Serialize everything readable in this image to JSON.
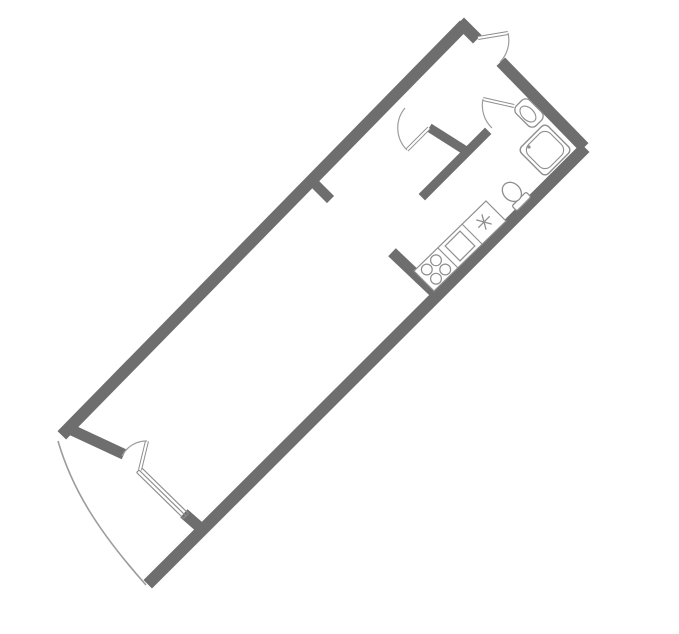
{
  "canvas": {
    "width": 679,
    "height": 634,
    "background": "#ffffff"
  },
  "palette": {
    "wall": "#6E6E6E",
    "interior_wall": "#707070",
    "fixture_line": "#8E8E8E",
    "thin_line": "#9C9C9C",
    "white": "#ffffff"
  },
  "plan": {
    "type": "studio-apartment-floor-plan",
    "rotation_note": "plan drawn rotated ~45deg, long axis from top-right to bottom-left",
    "rooms": [
      "entrance-hall",
      "bathroom",
      "kitchen-zone",
      "main-room",
      "balcony"
    ]
  },
  "walls": [
    {
      "name": "left-exterior-wall",
      "x1": 460,
      "y1": 29,
      "x2": 66,
      "y2": 431,
      "w": 12
    },
    {
      "name": "top-end-wall-left-piece",
      "x1": 464,
      "y1": 26,
      "x2": 473,
      "y2": 35,
      "w": 12
    },
    {
      "name": "top-end-wall-right-piece",
      "x1": 505,
      "y1": 66,
      "x2": 580,
      "y2": 143,
      "w": 12
    },
    {
      "name": "right-exterior-wall",
      "x1": 581,
      "y1": 152,
      "x2": 152,
      "y2": 580,
      "w": 12
    },
    {
      "name": "bottom-end-wall-corner-piece",
      "x1": 76,
      "y1": 432,
      "x2": 119,
      "y2": 452,
      "w": 11
    },
    {
      "name": "bottom-end-wall-window-jamb",
      "x1": 188,
      "y1": 517,
      "x2": 196,
      "y2": 524,
      "w": 11
    },
    {
      "name": "hall-partition",
      "x1": 433,
      "y1": 130,
      "x2": 463,
      "y2": 149,
      "w": 9
    },
    {
      "name": "bathroom-partition",
      "x1": 485,
      "y1": 134,
      "x2": 425,
      "y2": 194,
      "w": 9
    },
    {
      "name": "kitchen-stub-wall",
      "x1": 396,
      "y1": 256,
      "x2": 436,
      "y2": 294,
      "w": 11
    },
    {
      "name": "left-wall-stub",
      "x1": 318,
      "y1": 187,
      "x2": 327,
      "y2": 196,
      "w": 10
    }
  ],
  "paths": [
    {
      "name": "balcony-outline",
      "d": "M 58,441 C 72,489 98,531 146,585",
      "w": 1.6
    }
  ],
  "window": {
    "name": "balcony-window",
    "lines": [
      {
        "x1": 141.4,
        "y1": 467.5,
        "x2": 188.4,
        "y2": 513.5
      },
      {
        "x1": 139.0,
        "y1": 470.0,
        "x2": 186.0,
        "y2": 516.0
      },
      {
        "x1": 136.6,
        "y1": 472.5,
        "x2": 183.6,
        "y2": 518.5
      },
      {
        "x1": 141.4,
        "y1": 467.5,
        "x2": 136.6,
        "y2": 472.5
      },
      {
        "x1": 188.4,
        "y1": 513.5,
        "x2": 183.6,
        "y2": 518.5
      }
    ],
    "w": 1.2
  },
  "doors": [
    {
      "name": "entrance-door",
      "leaf": {
        "x1": 478,
        "y1": 38,
        "x2": 508,
        "y2": 33
      },
      "arc": "M 508,33 A 31,31 0 0 1 500,62"
    },
    {
      "name": "bathroom-door",
      "leaf": {
        "x1": 514,
        "y1": 106,
        "x2": 483,
        "y2": 99
      },
      "arc": "M 483,99 A 31,31 0 0 0 492,128"
    },
    {
      "name": "hall-room-door",
      "leaf": {
        "x1": 429,
        "y1": 128,
        "x2": 407,
        "y2": 150
      },
      "arc": "M 405,108 A 31,31 0 0 0 407,150"
    },
    {
      "name": "balcony-door",
      "leaf": {
        "x1": 140,
        "y1": 470,
        "x2": 147,
        "y2": 441
      },
      "arc": "M 147,441 A 27,27 0 0 0 122,456"
    }
  ],
  "shower": {
    "name": "shower-tray",
    "cx": 545,
    "cy": 150,
    "size": 38,
    "inset": 3.5,
    "rot": 45,
    "drain": {
      "cx": 529,
      "cy": 147,
      "r": 1.6
    }
  },
  "bath_sink": {
    "name": "bathroom-sink",
    "cx": 529,
    "cy": 113,
    "rot": 45,
    "outer_w": 28,
    "outer_h": 19,
    "rx": 6,
    "bowl_rx": 9.5,
    "bowl_ry": 6
  },
  "toilet": {
    "name": "toilet",
    "cx": 514,
    "cy": 194,
    "rot": 45,
    "bowl_rx": 10.5,
    "bowl_ry": 8.5,
    "tank": {
      "dx": 7,
      "dy": -10,
      "w": 7,
      "h": 20
    }
  },
  "counter": {
    "name": "kitchen-counter",
    "outline": [
      [
        486,
        201
      ],
      [
        506,
        221
      ],
      [
        434,
        291
      ],
      [
        414,
        271
      ]
    ],
    "dividers": [
      {
        "x1": 482,
        "y1": 244,
        "x2": 462,
        "y2": 224
      },
      {
        "x1": 458,
        "y1": 268,
        "x2": 438,
        "y2": 248
      }
    ],
    "sink_symbol": {
      "name": "kitchen-sink-symbol",
      "cx": 484,
      "cy": 222,
      "r": 8,
      "angles": [
        15,
        75,
        135
      ]
    },
    "oven": {
      "name": "oven",
      "cx": 460,
      "cy": 246,
      "size": 21,
      "rot": 45
    },
    "burners": {
      "name": "stove-burners",
      "r": 5.4,
      "circles": [
        [
          436,
          278.7
        ],
        [
          436,
          260.3
        ],
        [
          445.2,
          269.5
        ],
        [
          426.8,
          269.5
        ]
      ]
    }
  }
}
